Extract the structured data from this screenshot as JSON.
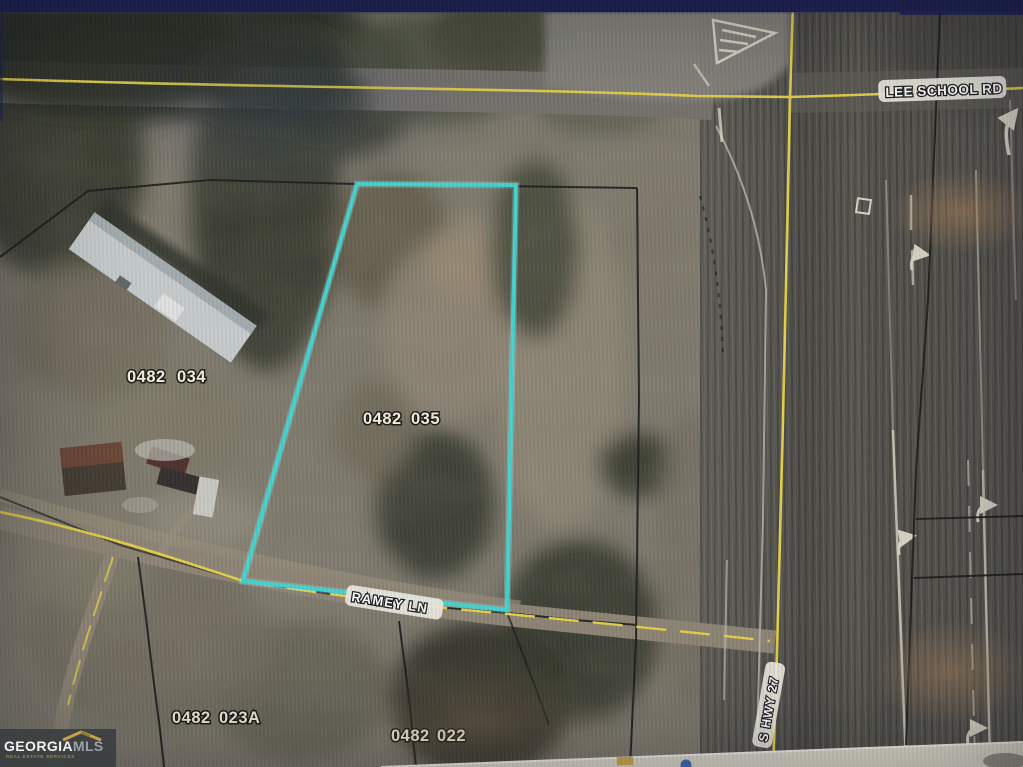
{
  "map": {
    "parcel_highlight_color": "#3ed3d0",
    "road_centerline_color": "#e3cf45",
    "boundary_color": "#161616",
    "road_labels": {
      "lee_school": "LEE SCHOOL RD",
      "s_hwy": "S HWY 27",
      "ramey": "RAMEY LN"
    },
    "parcels": [
      {
        "block": "0482",
        "lot": "034"
      },
      {
        "block": "0482",
        "lot": "035"
      },
      {
        "block": "0482",
        "lot": "023A"
      },
      {
        "block": "0482",
        "lot": "022"
      }
    ]
  },
  "watermark": {
    "brand_primary": "GEORGIA",
    "brand_secondary": "MLS",
    "tagline": "REAL ESTATE SERVICES",
    "accent_color": "#c7a04b"
  }
}
